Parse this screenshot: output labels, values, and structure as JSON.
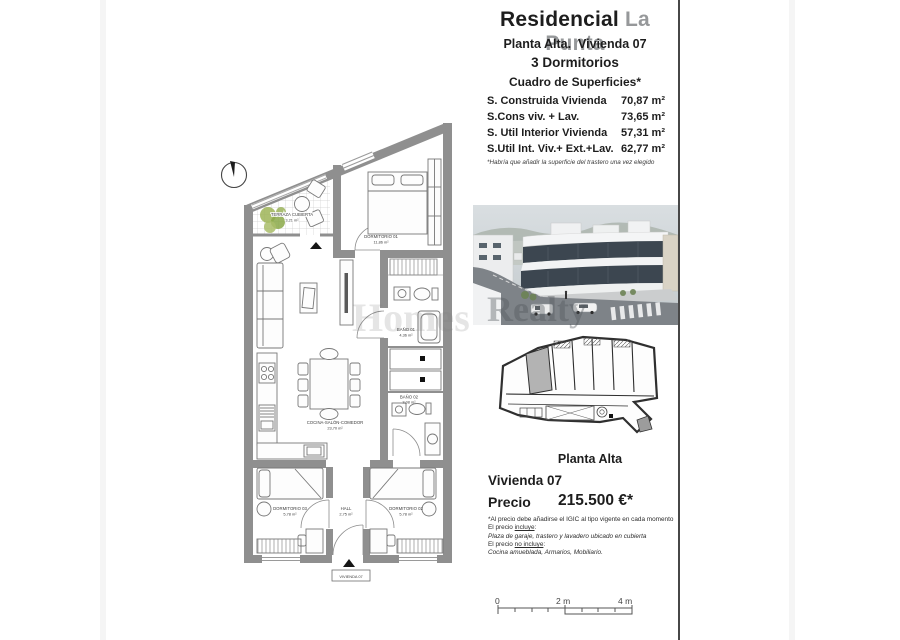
{
  "document": {
    "watermark_left": "Homes",
    "watermark_right": "Realty"
  },
  "header": {
    "title_main": "Residencial",
    "title_accent": "La Punta",
    "line1": "Planta Alta.  Vivienda 07",
    "line2": "3 Dormitorios",
    "line3": "Cuadro de Superficies*"
  },
  "surfaces": {
    "rows": [
      {
        "label": "S. Construida Vivienda",
        "value": "70,87 m²"
      },
      {
        "label": "S.Cons viv. + Lav.",
        "value": "73,65 m²"
      },
      {
        "label": "S. Util Interior Vivienda",
        "value": "57,31 m²"
      },
      {
        "label": "S.Util Int. Viv.+ Ext.+Lav.",
        "value": "62,77 m²"
      }
    ],
    "footnote": "*Habría que añadir la superficie del trastero una vez elegido"
  },
  "keyplan": {
    "caption": "Planta Alta"
  },
  "pricing": {
    "unit": "Vivienda 07",
    "price_label": "Precio",
    "price_value": "215.500 €*",
    "note_tax": "*Al precio debe añadirse el IGIC al tipo vigente en cada momento",
    "includes_prefix": "El precio ",
    "includes_word": "incluye",
    "colon": ":",
    "includes_detail": "Plaza de garaje, trastero y lavadero ubicado en cubierta",
    "excludes_prefix": "El precio ",
    "excludes_word": "no incluye",
    "excludes_detail": "Cocina amueblada, Armarios, Mobiliario."
  },
  "floorplan": {
    "unit_tag": "VIVIENDA 07",
    "rooms": {
      "terraza": {
        "name": "TERRAZA CUBIERTA",
        "area": "3,21 m²"
      },
      "dorm1": {
        "name": "DORMITORIO 01",
        "area": "11,86 m²"
      },
      "cocina": {
        "name": "COCINA-SALÓN-COMEDOR",
        "area": "23,70 m²"
      },
      "bano1": {
        "name": "BAÑO 01",
        "area": "4,36 m²"
      },
      "bano2": {
        "name": "BAÑO 02",
        "area": "3,08 m²"
      },
      "dorm3": {
        "name": "DORMITORIO 03",
        "area": "5,78 m²"
      },
      "hall": {
        "name": "HALL",
        "area": "2,75 m²"
      },
      "dorm2": {
        "name": "DORMITORIO 02",
        "area": "5,78 m²"
      }
    }
  },
  "scalebar": {
    "zero": "0",
    "two": "2 m",
    "four": "4 m"
  }
}
